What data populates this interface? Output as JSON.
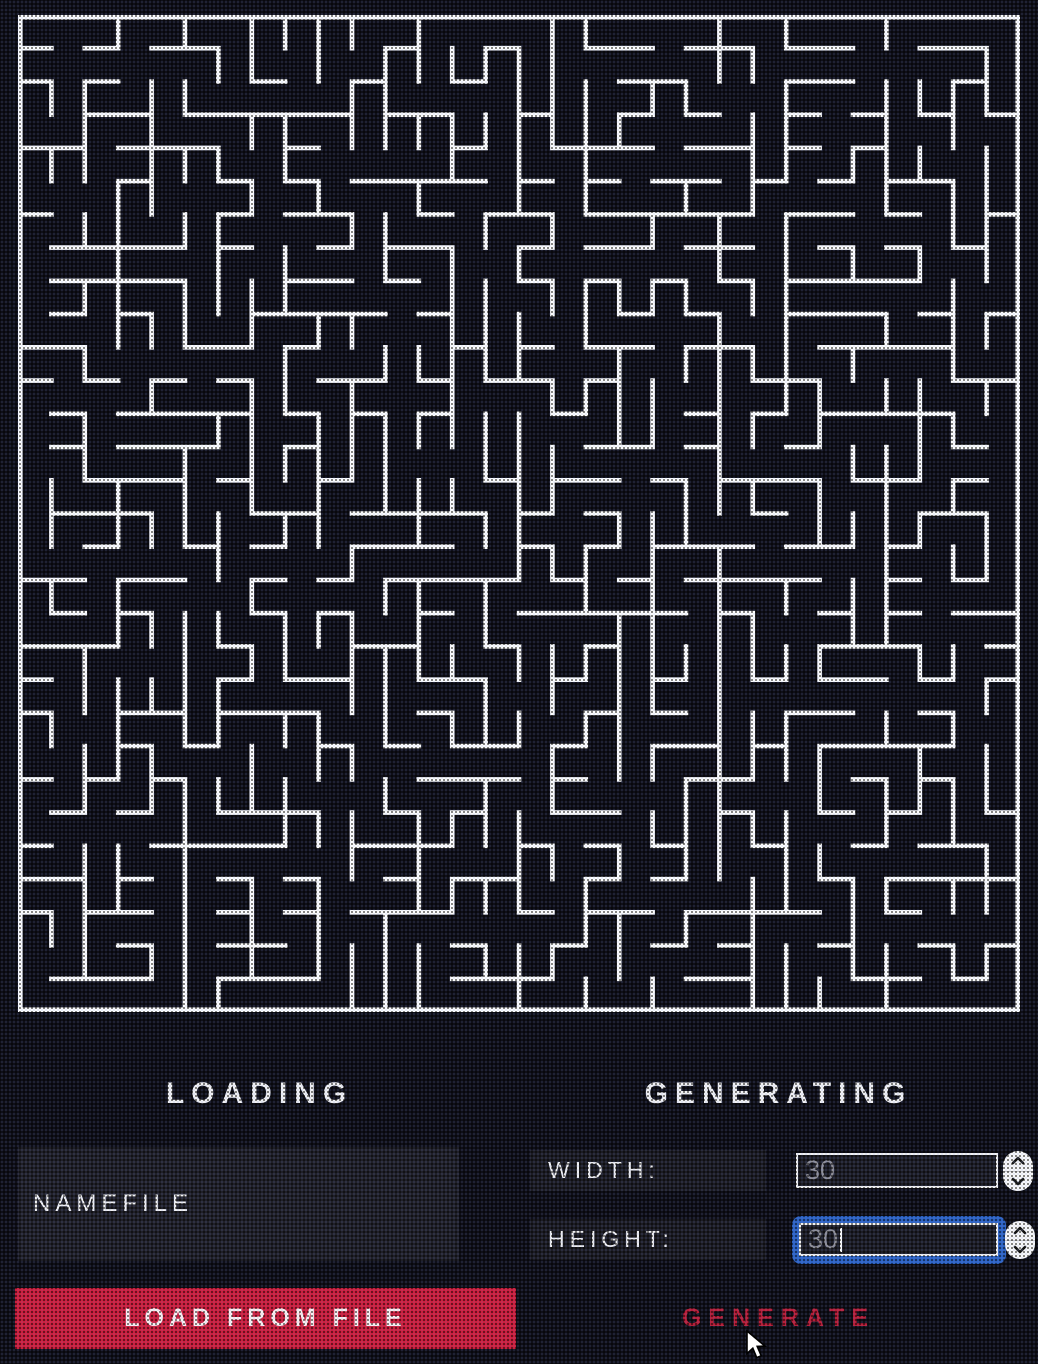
{
  "maze": {
    "rows": 30,
    "cols": 30,
    "seed": 11,
    "wall_thickness": 4.6,
    "wall_color": "#ffffff"
  },
  "loading": {
    "title": "LOADING",
    "namefile_value": "NAMEFILE",
    "load_button": "LOAD FROM FILE"
  },
  "generating": {
    "title": "GENERATING",
    "width_label": "WIDTH:",
    "width_value": "30",
    "height_label": "HEIGHT:",
    "height_value": "30",
    "generate_button": "GENERATE"
  },
  "icons": {
    "width_stepper_up": "chevron-up",
    "width_stepper_down": "chevron-down",
    "height_stepper_up": "chevron-up",
    "height_stepper_down": "chevron-down",
    "pointer": "arrow-cursor"
  },
  "colors": {
    "background": "#14141d",
    "maze_wall": "#ffffff",
    "panel_strip": "#23232c",
    "field_bg": "#1d1d25",
    "field_text": "#8f8f98",
    "button_red": "#ce1e3c",
    "generate_red": "#b91d37",
    "focus_blue": "#2c63c5",
    "text_white": "#f4f4f6"
  }
}
